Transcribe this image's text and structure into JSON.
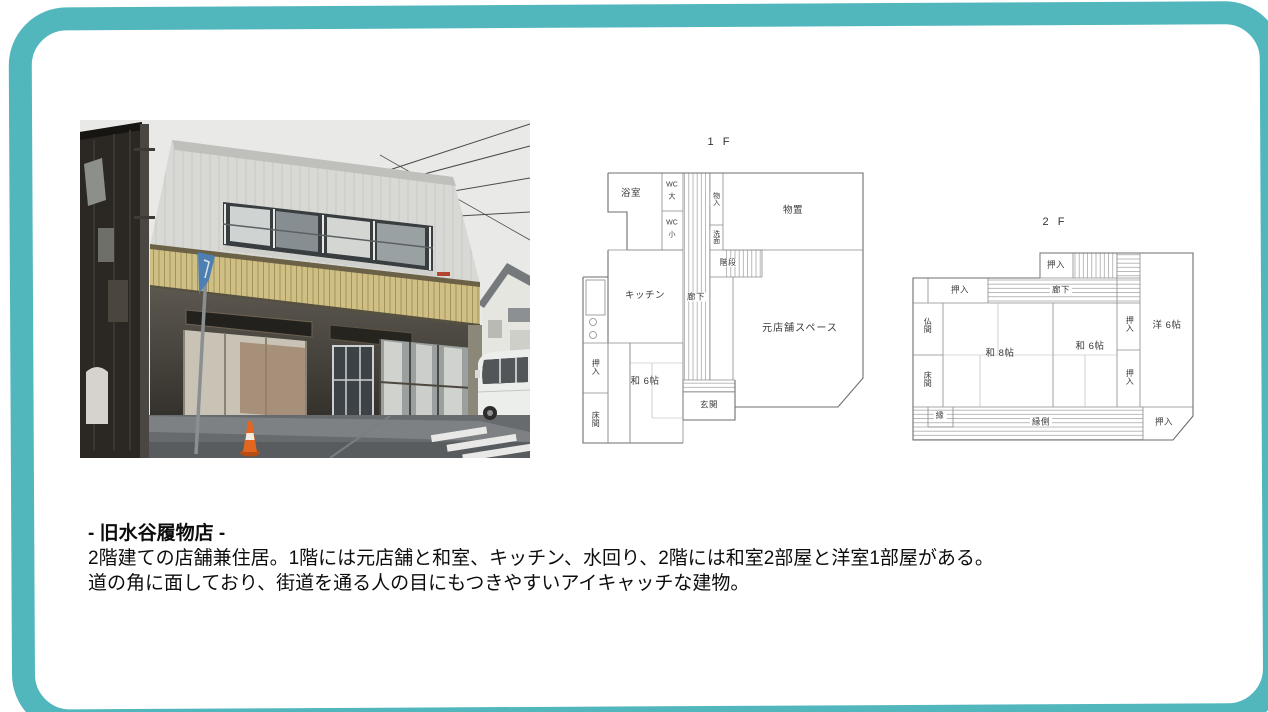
{
  "page": {
    "frame_color": "#52b7bd",
    "background": "#ffffff"
  },
  "photo": {
    "semantic": "exterior-photo-building-corner",
    "colors": {
      "sky": "#e9eae7",
      "wall": "#d8d9d5",
      "awning": "#cfbf85",
      "road": "#686b6d",
      "cone": "#e2661f",
      "sign": "#4d7fb2",
      "van": "#eceeec"
    }
  },
  "floorplan_1f": {
    "title": "1 F",
    "labels": {
      "bath": "浴室",
      "wc_large": {
        "line1": "WC",
        "line2": "大"
      },
      "wc_small": {
        "line1": "WC",
        "line2": "小"
      },
      "storage": "物入",
      "washstand": "洗面",
      "stairs": "階段",
      "storeroom": "物置",
      "kitchen": "キッチン",
      "corridor": "廊下",
      "closet": "押入",
      "tatami6": "和 6帖",
      "alcove": "床間",
      "entrance": "玄関",
      "former_shop": "元店舗スペース"
    }
  },
  "floorplan_2f": {
    "title": "2 F",
    "labels": {
      "closet_top": "押入",
      "closet_left": "押入",
      "corridor": "廊下",
      "butsuma": "仏間",
      "alcove": "床間",
      "tatami8": "和 8帖",
      "tatami6": "和 6帖",
      "closet_right_upper": "押入",
      "closet_right_lower": "押入",
      "western6": "洋 6帖",
      "en": "縁",
      "engawa": "縁側",
      "closet_bottom": "押入"
    }
  },
  "caption": {
    "title": "- 旧水谷履物店 -",
    "body_line1": "2階建ての店舗兼住居。1階には元店舗と和室、キッチン、水回り、2階には和室2部屋と洋室1部屋がある。",
    "body_line2": "道の角に面しており、街道を通る人の目にもつきやすいアイキャッチな建物。"
  }
}
